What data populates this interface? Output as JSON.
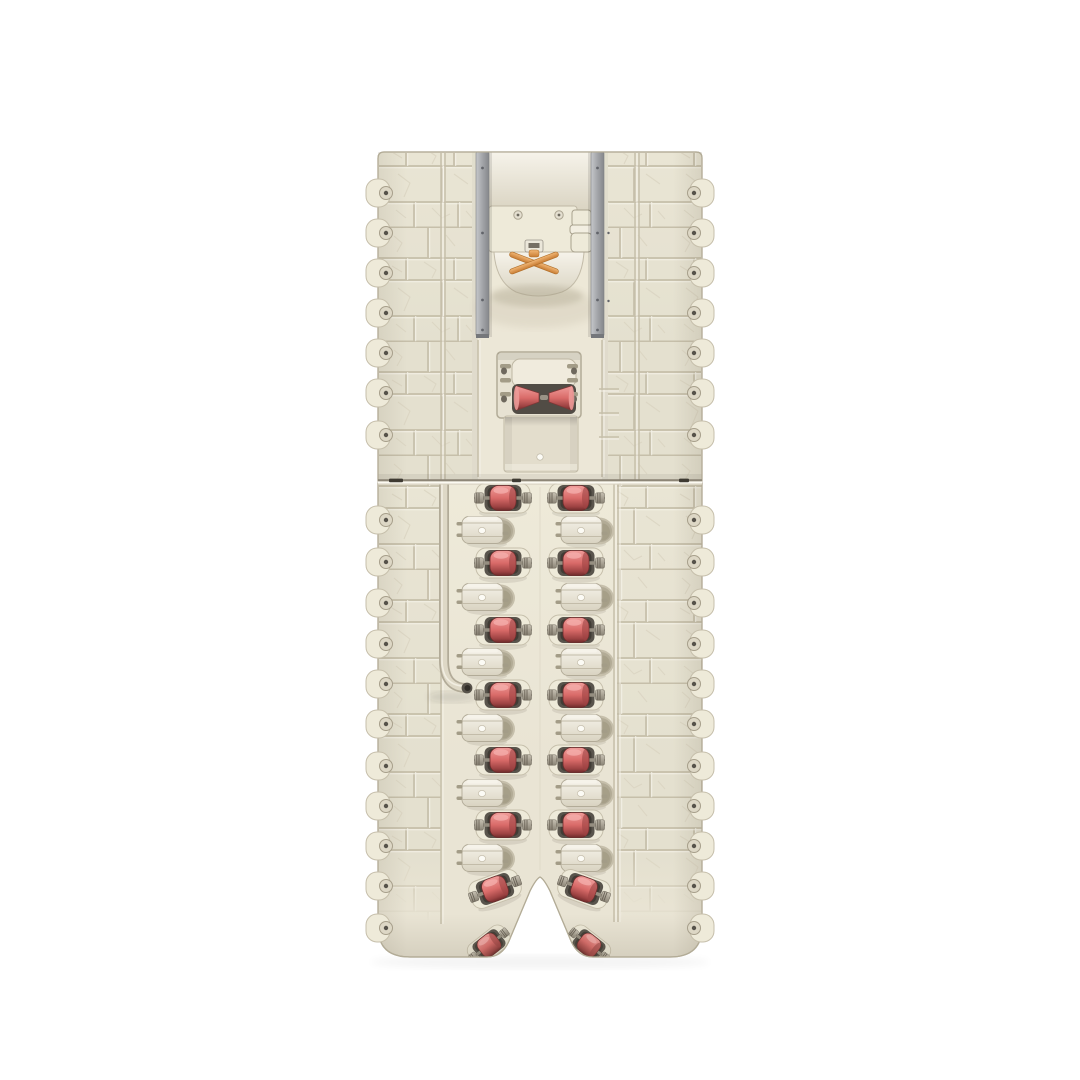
{
  "scene": {
    "title": "Playset rear panel render",
    "description": "Rear view 3D render of a two-piece cream plastic playset wall: rock-texture side panels with screw tabs, twin gray metal rails, a housing with orange rope hook, a guide-cone module with tray, a curved cable tube, and two columns of alternating red barrel rollers and cream caps above a V-notched footed base",
    "background": "#ffffff"
  },
  "colors": {
    "white_bg": "#ffffff",
    "body": "#e9e4d4",
    "body_light": "#eeead checked",
    "body_lighter": "#f6f3ea",
    "body_dark": "#d9d3c1",
    "body_deep": "#c6bfab",
    "groove": "#c6bfaa",
    "crack": "#d9d3c0",
    "outline": "#b3ac97",
    "rail": "#a6a8ac",
    "rail_light": "#c6c8cb",
    "rail_dark": "#85878b",
    "red": "#d96b69",
    "red_light": "#f09d9a",
    "red_dark": "#9c4242",
    "red_deep": "#6e2b2b",
    "pocket": "#59544c",
    "pocket_deep": "#403c35",
    "metal": "#a8a193",
    "metal_dark": "#6e685c",
    "orange": "#e8a15c",
    "orange_dark": "#c87c33",
    "white_dot": "#fcfbf5",
    "seam": "#8d8677",
    "seam_highlight": "#fcfaf2",
    "shadow": "rgba(60,52,38,0.12)"
  },
  "structure": {
    "object_bounds": {
      "x": 378,
      "y": 152,
      "width": 324,
      "height": 806
    },
    "seam_y": 481,
    "rails": {
      "left_x": 476,
      "right_x": 591,
      "width": 13,
      "top": 152,
      "height": 184,
      "screw_ys": [
        168,
        233,
        300,
        330
      ]
    },
    "seam_ticks": [
      {
        "x": 389,
        "w": 14
      },
      {
        "x": 512,
        "w": 9
      },
      {
        "x": 679,
        "w": 10
      }
    ],
    "edge_tabs": {
      "left_edge_x": 378,
      "right_edge_x": 702,
      "top_half_ys": [
        193,
        233,
        273,
        313,
        353,
        393,
        435
      ],
      "bottom_half_ys": [
        520,
        562,
        603,
        644,
        684,
        724,
        766,
        806,
        846,
        886,
        928
      ]
    },
    "rollers": {
      "left_red_x": 503,
      "right_red_x": 576,
      "left_cream_x": 489,
      "right_cream_x": 588,
      "rows": [
        {
          "type": "red",
          "y": 498
        },
        {
          "type": "cream",
          "y": 530
        },
        {
          "type": "red",
          "y": 563
        },
        {
          "type": "cream",
          "y": 597
        },
        {
          "type": "red",
          "y": 630
        },
        {
          "type": "cream",
          "y": 662
        },
        {
          "type": "red",
          "y": 695
        },
        {
          "type": "cream",
          "y": 728
        },
        {
          "type": "red",
          "y": 760
        },
        {
          "type": "cream",
          "y": 793
        },
        {
          "type": "red",
          "y": 825
        },
        {
          "type": "cream",
          "y": 858
        },
        {
          "type": "red",
          "y": 889,
          "xl": 495,
          "xr": 584,
          "tilt": 20,
          "scale": 0.95
        },
        {
          "type": "red",
          "y": 945,
          "xl": 489,
          "xr": 589,
          "tilt": 38,
          "scale": 0.82
        }
      ]
    },
    "counts": {
      "red_rollers": 16,
      "cream_rollers": 12
    }
  }
}
